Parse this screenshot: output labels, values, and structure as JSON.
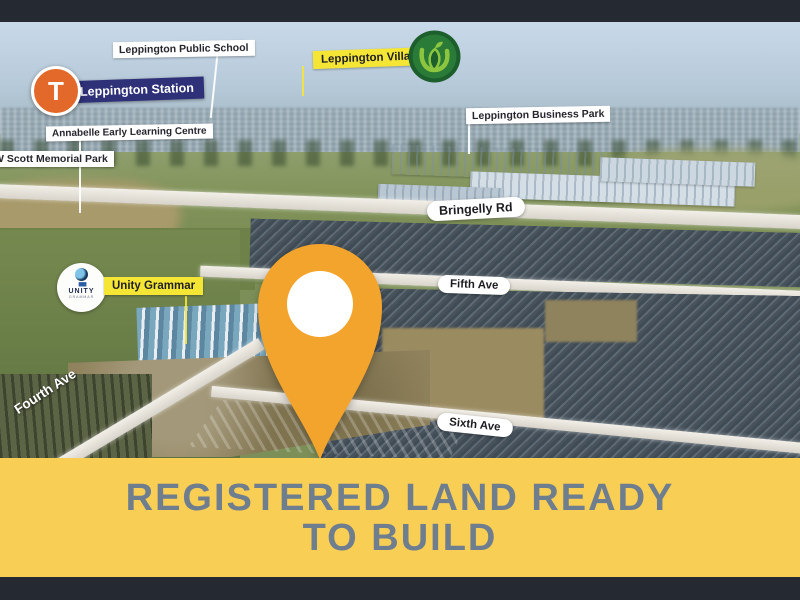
{
  "banner": {
    "line1": "REGISTERED LAND READY",
    "line2": "TO BUILD"
  },
  "labels": {
    "public_school": "Leppington Public School",
    "station": "Leppington Station",
    "annabelle": "Annabelle Early Learning Centre",
    "memorial_park": "W Scott Memorial Park",
    "village": "Leppington Village",
    "business_park": "Leppington Business Park",
    "unity_grammar": "Unity Grammar"
  },
  "roads": {
    "bringelly": "Bringelly Rd",
    "fourth": "Fourth Ave",
    "fifth": "Fifth Ave",
    "sixth": "Sixth Ave"
  },
  "icons": {
    "station_letter": "T",
    "unity_title": "UNITY",
    "unity_subtitle": "GRAMMAR",
    "names": [
      "train-t-icon",
      "woolworths-icon",
      "unity-grammar-icon",
      "location-pin-icon"
    ]
  },
  "colors": {
    "banner_yellow": "#F8CE55",
    "banner_text": "#6E7E8E",
    "pin_orange": "#F3A42C",
    "label_yellow": "#F5E636",
    "station_navy": "#2E3078",
    "station_orange": "#E2692A",
    "woolworths_green": "#1C5E2C",
    "water_teal": "#2FAEC4",
    "letterbox_dark": "#252A32"
  }
}
